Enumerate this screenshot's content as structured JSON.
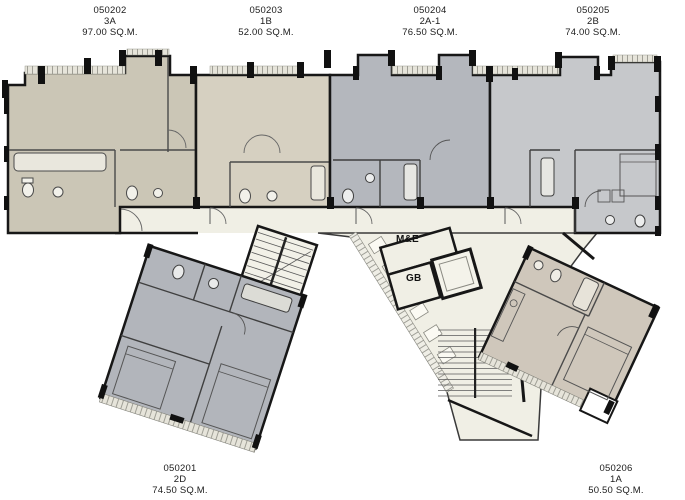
{
  "plan": {
    "units": [
      {
        "number": "050202",
        "type": "3A",
        "area": "97.00 SQ.M."
      },
      {
        "number": "050203",
        "type": "1B",
        "area": "52.00 SQ.M."
      },
      {
        "number": "050204",
        "type": "2A-1",
        "area": "76.50 SQ.M."
      },
      {
        "number": "050205",
        "type": "2B",
        "area": "74.00 SQ.M."
      },
      {
        "number": "050201",
        "type": "2D",
        "area": "74.50 SQ.M."
      },
      {
        "number": "050206",
        "type": "1A",
        "area": "50.50 SQ.M."
      }
    ],
    "rooms": {
      "me": "M&E",
      "gb": "GB"
    },
    "colors": {
      "unit_3a": "#cbc6b6",
      "unit_1b": "#d6d0c1",
      "unit_2a1": "#b4b7bd",
      "unit_2b": "#c6c8cb",
      "unit_2d": "#b2b5bb",
      "unit_1a": "#cfc7bb",
      "corridor": "#f0efe5",
      "walls": "#171717"
    }
  }
}
